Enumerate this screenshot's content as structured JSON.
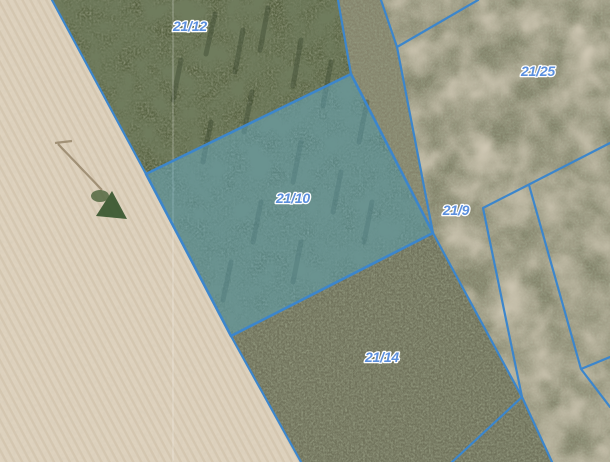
{
  "map": {
    "type": "cadastral-parcel-map-on-orthophoto",
    "selected_parcel": "21/10",
    "parcels": [
      {
        "label": "21/12",
        "selected": false
      },
      {
        "label": "21/25",
        "selected": false
      },
      {
        "label": "21/10",
        "selected": true
      },
      {
        "label": "21/9",
        "selected": false
      },
      {
        "label": "21/14",
        "selected": false
      }
    ],
    "colors": {
      "boundary_line": "#3c86cc",
      "selection_fill": "#63b0cf",
      "label_text": "#5b8fdd",
      "label_halo": "#ffffff",
      "field_tan": "#ded2be",
      "forest_dark": "#55603f",
      "grass_light": "#85846c",
      "scrub_medium": "#70725b",
      "seam_line": "#ffffff"
    }
  }
}
